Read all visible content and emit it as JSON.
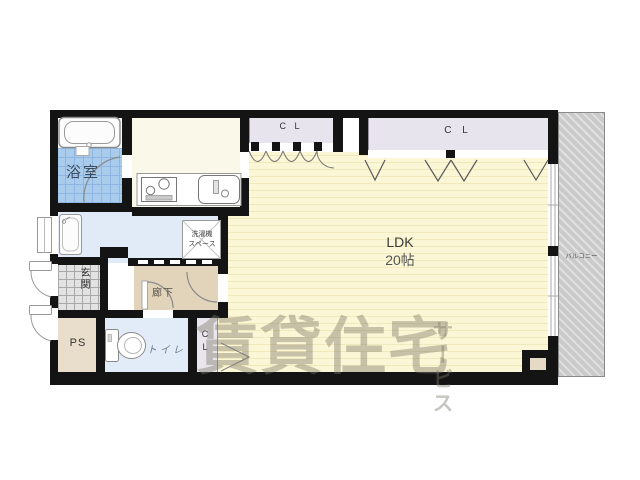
{
  "floorplan": {
    "rooms": {
      "bathroom": {
        "label": "浴室"
      },
      "washer_space": {
        "line1": "洗濯機",
        "line2": "スペース"
      },
      "entrance": {
        "label": "玄関"
      },
      "hallway": {
        "label": "廊下"
      },
      "pipe_space": {
        "label": "PS"
      },
      "toilet": {
        "label": "トイレ"
      },
      "closet_bottom": {
        "label": "CL"
      },
      "closet_top_left": {
        "label": "C L"
      },
      "closet_top_right": {
        "label": "C L"
      },
      "ldk": {
        "label": "LDK",
        "size": "20帖"
      },
      "balcony": {
        "label": "バルコニー"
      }
    },
    "watermark": {
      "main": "賃貸住宅",
      "vertical": "サービス"
    },
    "colors": {
      "wall": "#141414",
      "ldk_floor": "#FBF6D5",
      "ldk_stripe": "#F0E9BC",
      "bath_tile": "#A9CBEC",
      "water_room": "#E1EBF7",
      "hallway": "#E2D4BB",
      "closet": "#E8E4ED",
      "entrance_tile": "#E2E2E2",
      "balcony": "#CACACA"
    }
  }
}
